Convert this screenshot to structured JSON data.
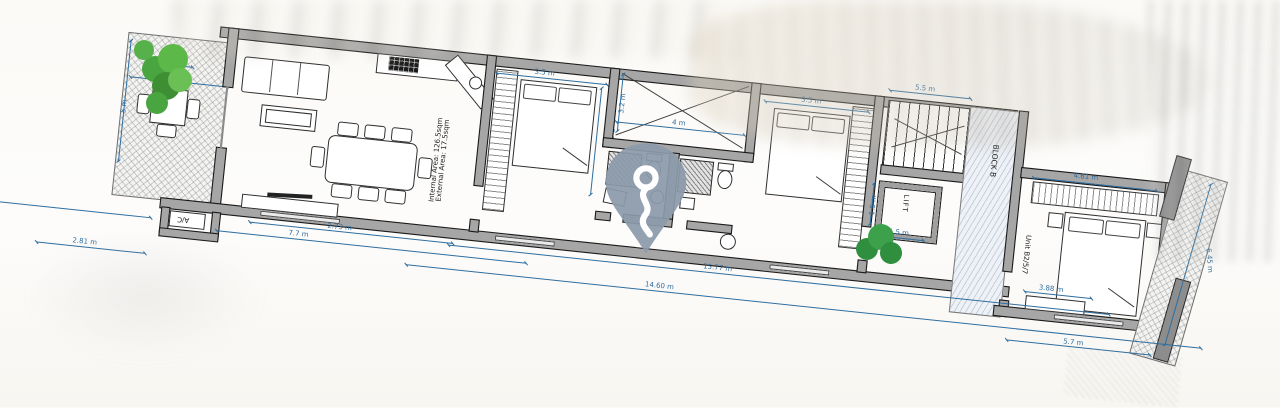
{
  "document": {
    "type": "floor-plan",
    "view": "scanned plan with location marker overlay"
  },
  "labels": {
    "internal_area": "Internal Area: 126.5sqm",
    "external_area": "External Area: 17.5sqm",
    "lift": "LIFT",
    "block": "BLOCK B",
    "unit": "Unit B2/5/7",
    "ac": "A/C"
  },
  "dims": {
    "terrace_top": "4 m",
    "terrace_width": "2.81 m",
    "terrace_side": "5 m",
    "outside_left": "2.81 m",
    "tv_wall": "2.73 m",
    "living_facade": "7.7 m",
    "bed1_width": "3.5 m",
    "bed1_depth": "3.6 m",
    "shaft_width": "4 m",
    "shaft_depth": "3.2 m",
    "bed2_width": "3.5 m",
    "stairs_width": "5.5 m",
    "lift_depth": "1.5 m",
    "lift_width": "1.5 m",
    "wardrobe3_width": "4.61 m",
    "cabinet3_width": "3.88 m",
    "facade_total": "15.77 m",
    "facade_inner": "14.60 m",
    "bed3_facade": "5.7 m",
    "terrace_right_length": "6.45 m"
  },
  "colors": {
    "dimension": "#2e6ea0",
    "wall_fill": "#a6a6a6",
    "pin": "#8b9aab",
    "tree": "#4da345",
    "corridor_hatch": "#8296b4"
  },
  "icons": {
    "pin": "location-pin",
    "pin_glyph": "route-curve",
    "tree": "tree",
    "bush": "bush"
  }
}
